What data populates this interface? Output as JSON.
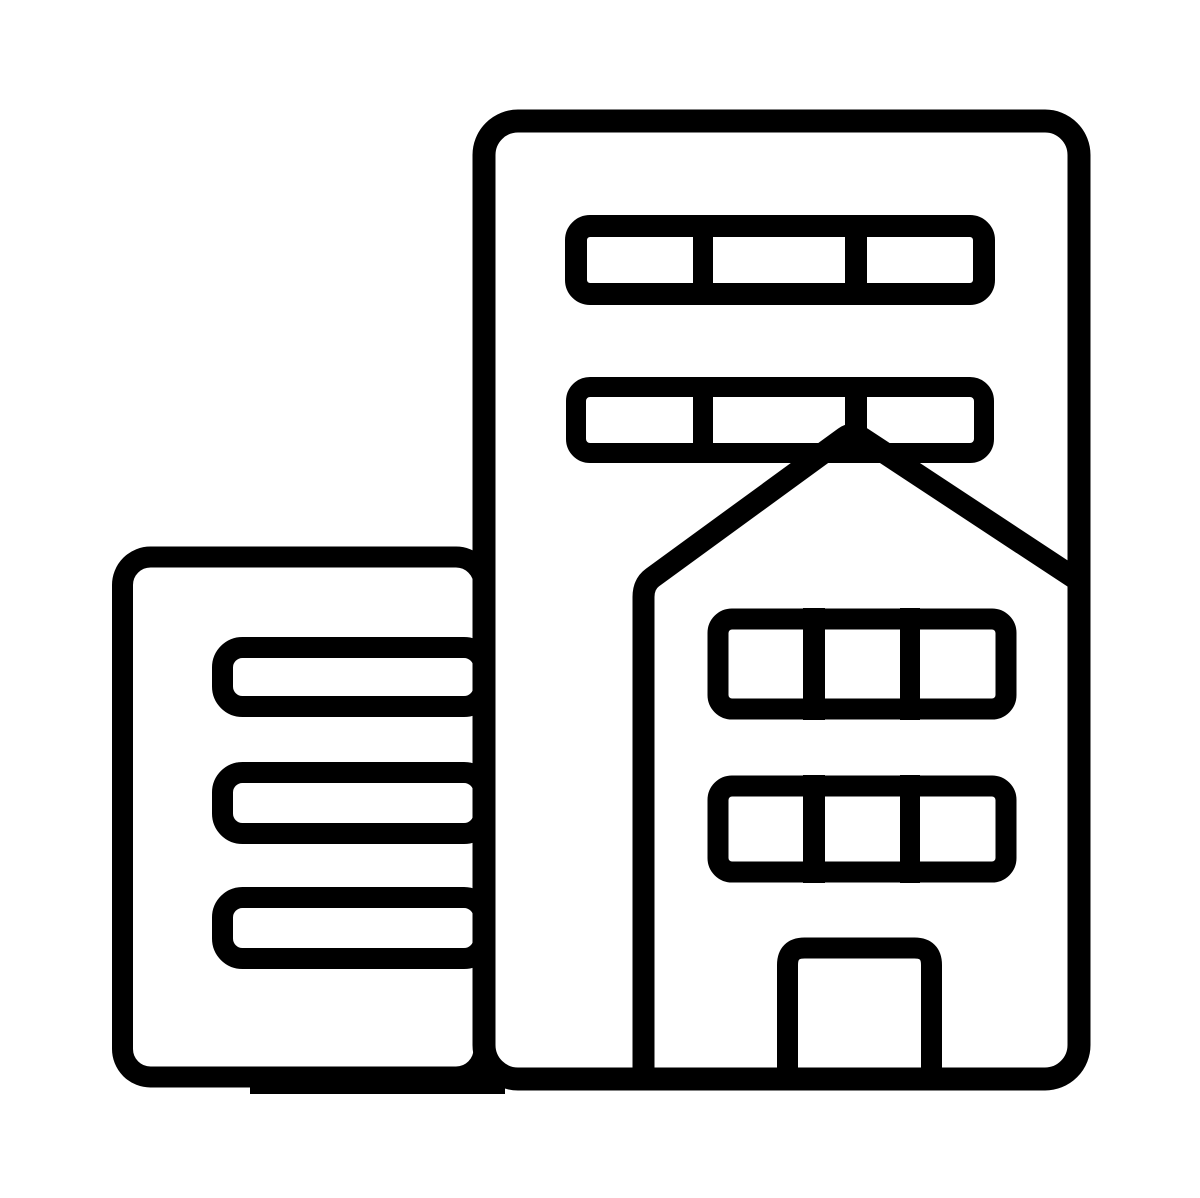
{
  "canvas": {
    "width": 1200,
    "height": 1198,
    "viewBox": "0 0 1200 1198"
  },
  "page": {
    "background": "#ffffff"
  },
  "icon": {
    "name": "office-buildings-icon",
    "style": "black outline glyph",
    "color": "#000000",
    "parts": [
      "tall-building-outline",
      "tall-building-window-row-1",
      "tall-building-window-row-2",
      "window-pane-dividers",
      "house-roof-and-left-wall",
      "house-window-row-1",
      "house-window-row-2",
      "house-door",
      "small-building-outline",
      "small-building-window-bar-1",
      "small-building-window-bar-2",
      "small-building-window-bar-3",
      "ground-segment"
    ]
  }
}
